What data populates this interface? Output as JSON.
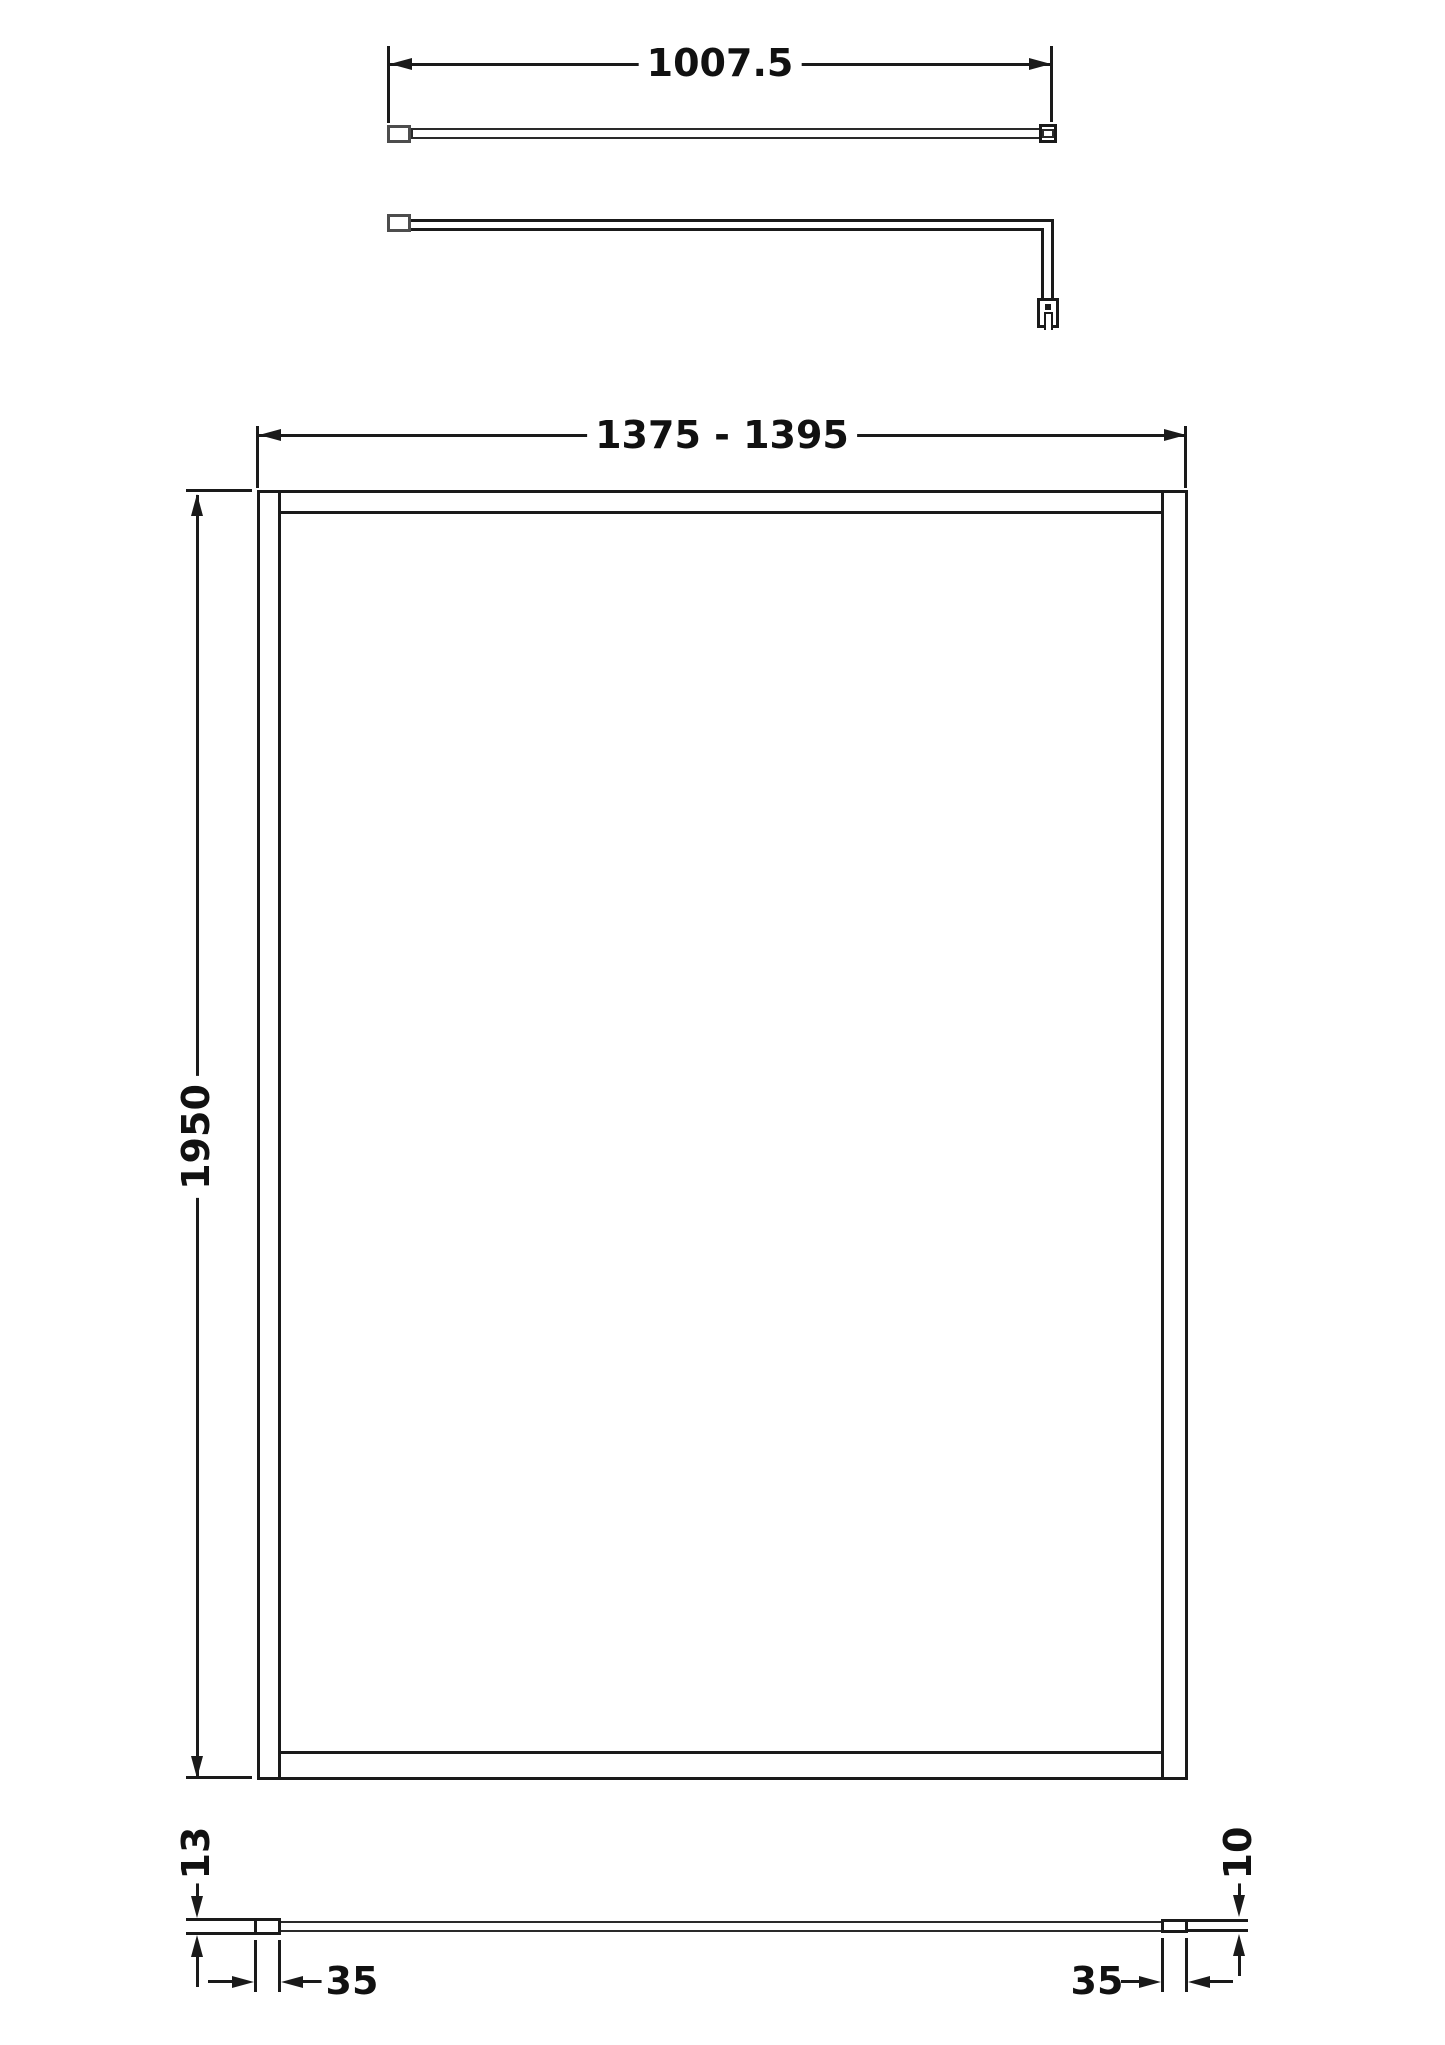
{
  "colors": {
    "line": "#1a1a1a",
    "background": "#ffffff"
  },
  "views": {
    "support_bar_top": {
      "dimension": {
        "label": "1007.5"
      }
    },
    "front": {
      "width_dimension": {
        "label": "1375 - 1395"
      },
      "height_dimension": {
        "label": "1950"
      }
    },
    "plan_profile": {
      "left_depth_dimension": {
        "label": "13"
      },
      "left_width_dimension": {
        "label": "35"
      },
      "right_depth_dimension": {
        "label": "10"
      },
      "right_width_dimension": {
        "label": "35"
      }
    }
  }
}
